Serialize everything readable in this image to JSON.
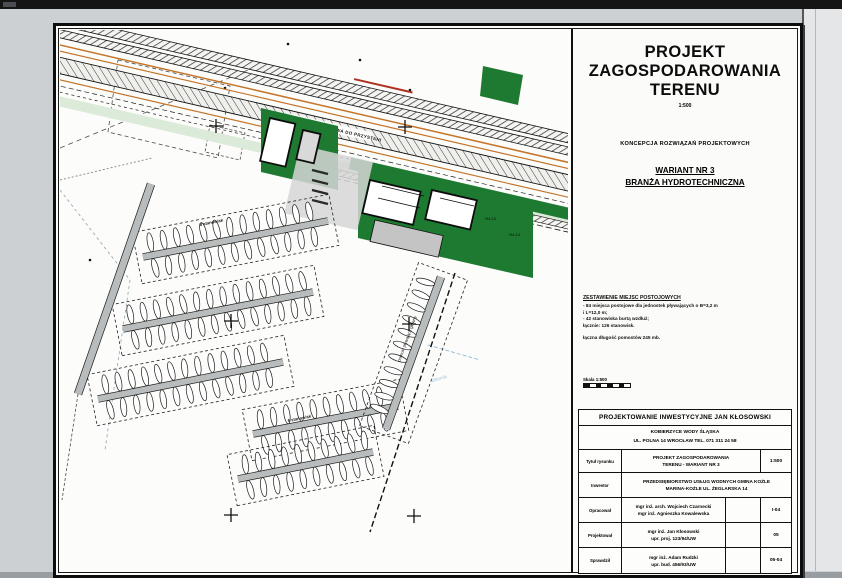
{
  "colors": {
    "green": "#1e7a31",
    "pale_green": "#dcead9",
    "pontoon_gray": "#b9bcbc",
    "utility_orange": "#c4752a",
    "water_blue": "#9cc2d6",
    "line_black": "#1a1a1a"
  },
  "titleblock": {
    "title_line1": "PROJEKT",
    "title_line2": "ZAGOSPODAROWANIA",
    "title_line3": "TERENU",
    "scale": "1:500",
    "subtitle": "KONCEPCJA ROZWIĄZAŃ PROJEKTOWYCH",
    "variant_line1": "WARIANT NR 3",
    "variant_line2": "BRANŻA HYDROTECHNICZNA",
    "legend": {
      "heading": "ZESTAWIENIE MIEJSC POSTOJOWYCH",
      "lines": [
        "- 84 miejsca postojowe dla jednostek pływających o B=3,2 m",
        "i L=12,0 m;",
        "- 42 stanowiska burtą wzdłuż;",
        "łącznie: 126 stanowisk.",
        "",
        "łączna długość pomostów 245 mb."
      ]
    },
    "scale_mark_label": "Skala 1:500",
    "table": {
      "company": "PROJEKTOWANIE INWESTYCYJNE JAN KŁOSOWSKI",
      "address_line1": "KOBIERZYCE WODY ŚLĄSKA",
      "address_line2": "UL. POLNA 14 WROCŁAW  TEL. 071 311 24 58",
      "rows": [
        {
          "label": "Tytuł rysunku",
          "content1": "PROJEKT ZAGOSPODAROWANIA",
          "content2": "TERENU - WARIANT NR 3",
          "right": "1:500"
        },
        {
          "label": "Inwestor",
          "content1": "PRZEDSIĘBIORSTWO USŁUG WODNYCH GMINA KOŹLE",
          "content2": "MARINA-KOŹLE UL. ŻEGLARSKA 14",
          "right": ""
        },
        {
          "label": "Opracował",
          "content1": "mgr inż. arch. Wojciech Czarnecki",
          "content2": "mgr inż. Agnieszka Kowalewska",
          "right": "I-04"
        },
        {
          "label": "Projektował",
          "content1": "mgr inż. Jan Kłosowski",
          "content2": "upr. proj. 123/94/UW",
          "right": "05"
        },
        {
          "label": "Sprawdził",
          "content1": "mgr inż. Adam Rudzki",
          "content2": "upr. bud. 456/93/UW",
          "right": "05-04"
        }
      ]
    }
  },
  "map": {
    "road_label": "DROGA DOJAZDOWA DO PRZYSTANI",
    "pier_label": "pomost pływający główny",
    "water_label": "zbiornik",
    "spot_label_1": "+44.14",
    "spot_label_2": "+44.10",
    "berth_label_1": "8 stanowisk",
    "berth_label_2": "6 stanowisk"
  },
  "marina": {
    "boat_spacing": 13.5,
    "boat_offset": 13,
    "piers": [
      {
        "x1": 83,
        "y1": 227,
        "x2": 268,
        "y2": 191,
        "w": 6,
        "boats": "both"
      },
      {
        "x1": 63,
        "y1": 299,
        "x2": 253,
        "y2": 262,
        "w": 6,
        "boats": "both"
      },
      {
        "x1": 38,
        "y1": 369,
        "x2": 223,
        "y2": 332,
        "w": 6,
        "boats": "both"
      },
      {
        "x1": 193,
        "y1": 404,
        "x2": 338,
        "y2": 376,
        "w": 6,
        "boats": "both"
      },
      {
        "x1": 178,
        "y1": 449,
        "x2": 313,
        "y2": 422,
        "w": 6,
        "boats": "both"
      },
      {
        "x1": 91,
        "y1": 154,
        "x2": 18,
        "y2": 364,
        "w": 7,
        "boats": "none"
      },
      {
        "x1": 381,
        "y1": 247,
        "x2": 326,
        "y2": 399,
        "w": 7,
        "boats": "left"
      }
    ],
    "crosses": [
      [
        156,
        96
      ],
      [
        345,
        97
      ],
      [
        171,
        291
      ],
      [
        349,
        294
      ],
      [
        171,
        485
      ],
      [
        354,
        486
      ]
    ]
  }
}
